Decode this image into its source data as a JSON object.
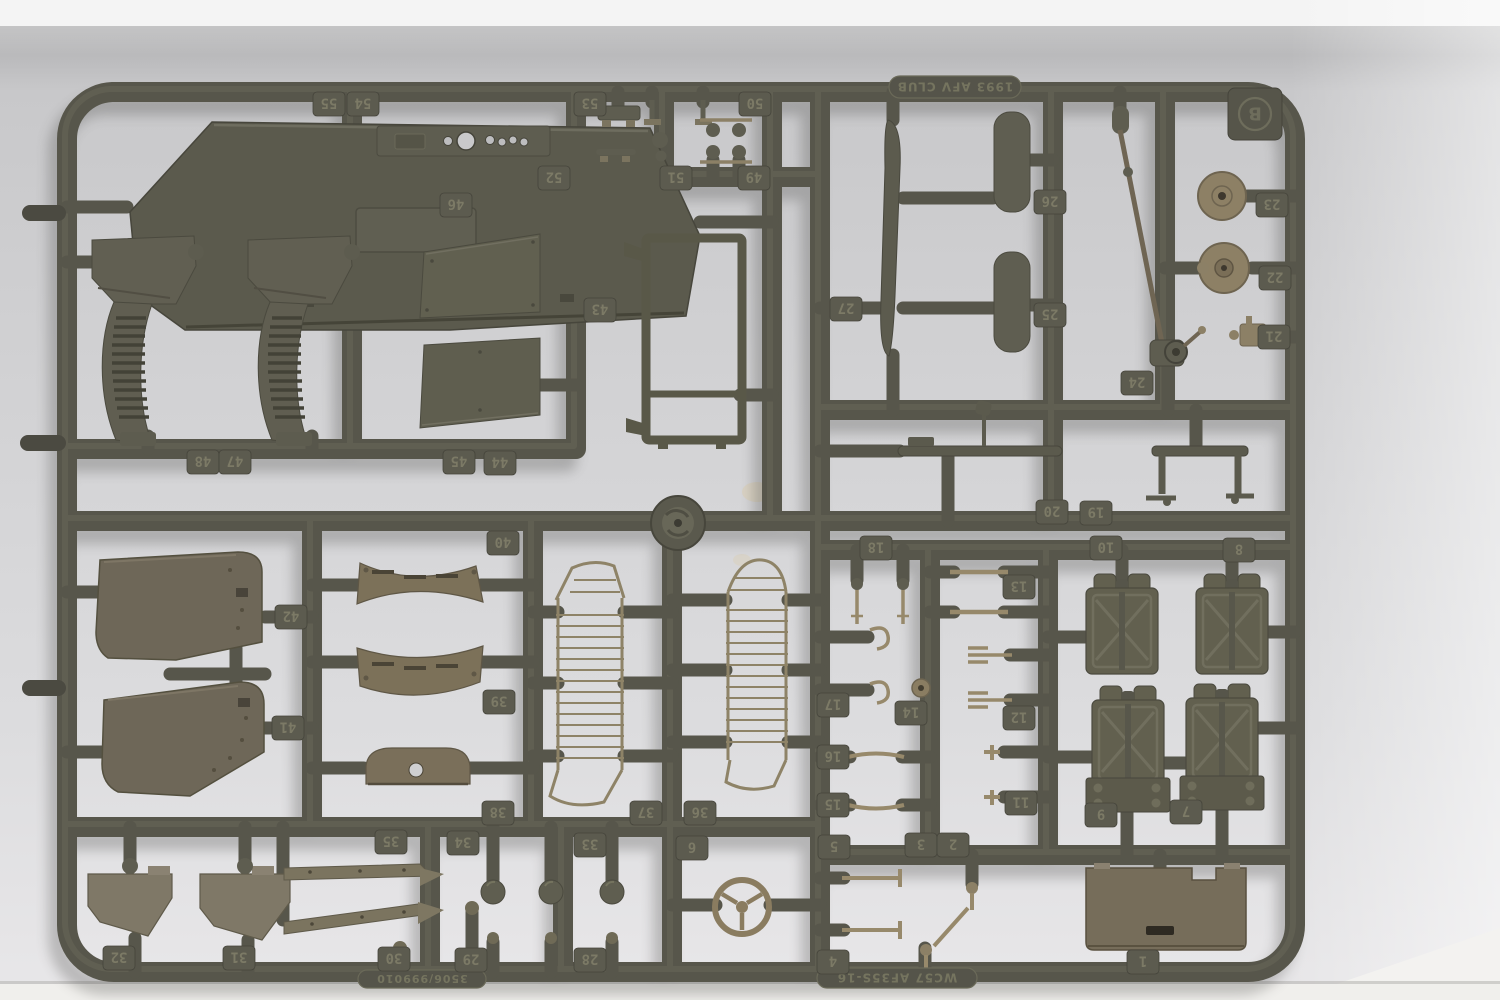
{
  "photo": {
    "subject": "Olive-drab injection-molded model kit sprue (parts tree), runner frame B, photographed on a light gray background",
    "notable_parts": [
      "engine hood panel",
      "dashboard with gauge holes",
      "two fender units with louvered grilles",
      "windshield frame",
      "two flat windshield glazing panels",
      "leaf spring",
      "steering column",
      "two round discs",
      "lever bench",
      "two mesh seat-back lattices",
      "two large door panels",
      "curved louvered seat parts",
      "four jerry cans (two with mounting bases)",
      "three-spoke steering wheel",
      "round injection gate disc",
      "rear body panel",
      "many small levers, pins, hooks and balls"
    ]
  },
  "sprue": {
    "letter": "B",
    "top_marking": "1993 AFV CLUB",
    "bottom_marking": "WC57 AF35S-16",
    "mold_marking": "3506/999010",
    "marking_note": "all embossed text and part numbers appear rotated 180° in the photo",
    "colors": {
      "runner": "#57564b",
      "runner_highlight": "#6c6b5a",
      "part_olive": "#5e5d50",
      "part_brown": "#6e6758",
      "part_tan": "#8c8066",
      "tag_plate": "#5c5b4f",
      "tag_text": "#7c7a66",
      "background_wall": "#cfcfd1",
      "background_top_strip": "#f4f4f4",
      "background_bottom_strip": "#f0efec"
    },
    "part_tags": [
      {
        "n": "55"
      },
      {
        "n": "54"
      },
      {
        "n": "53"
      },
      {
        "n": "52"
      },
      {
        "n": "51"
      },
      {
        "n": "50"
      },
      {
        "n": "49"
      },
      {
        "n": "46"
      },
      {
        "n": "43"
      },
      {
        "n": "48"
      },
      {
        "n": "47"
      },
      {
        "n": "45"
      },
      {
        "n": "44"
      },
      {
        "n": "42"
      },
      {
        "n": "41"
      },
      {
        "n": "40"
      },
      {
        "n": "39"
      },
      {
        "n": "38"
      },
      {
        "n": "37"
      },
      {
        "n": "36"
      },
      {
        "n": "35"
      },
      {
        "n": "34"
      },
      {
        "n": "33"
      },
      {
        "n": "32"
      },
      {
        "n": "31"
      },
      {
        "n": "30"
      },
      {
        "n": "29"
      },
      {
        "n": "28"
      },
      {
        "n": "27"
      },
      {
        "n": "26"
      },
      {
        "n": "25"
      },
      {
        "n": "24"
      },
      {
        "n": "23"
      },
      {
        "n": "22"
      },
      {
        "n": "21"
      },
      {
        "n": "20"
      },
      {
        "n": "19"
      },
      {
        "n": "18"
      },
      {
        "n": "17"
      },
      {
        "n": "16"
      },
      {
        "n": "15"
      },
      {
        "n": "14"
      },
      {
        "n": "13"
      },
      {
        "n": "12"
      },
      {
        "n": "11"
      },
      {
        "n": "10"
      },
      {
        "n": "9"
      },
      {
        "n": "8"
      },
      {
        "n": "7"
      },
      {
        "n": "6"
      },
      {
        "n": "5"
      },
      {
        "n": "4"
      },
      {
        "n": "3"
      },
      {
        "n": "2"
      },
      {
        "n": "1"
      }
    ]
  }
}
